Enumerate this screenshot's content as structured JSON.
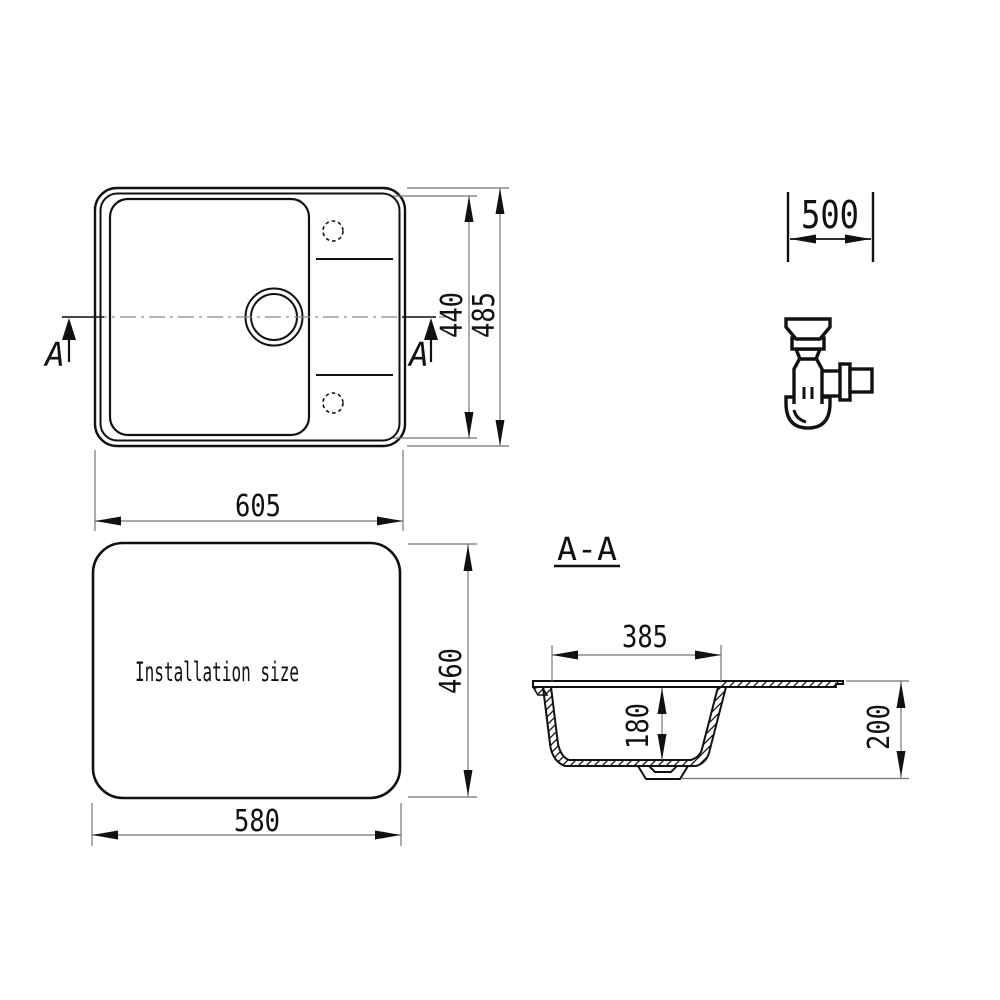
{
  "colors": {
    "background": "#ffffff",
    "object_line": "#111111",
    "dimension_line": "#757575"
  },
  "top_view": {
    "description": "sink plan view",
    "dim_width": "605",
    "dim_depth_inner": "440",
    "dim_depth_outer": "485",
    "section_marker_left": "A",
    "section_marker_right": "A"
  },
  "install_view": {
    "label": "Installation size",
    "dim_width": "580",
    "dim_depth": "460"
  },
  "section_view": {
    "title": "A-A",
    "dim_bowl_width": "385",
    "dim_bowl_depth": "180",
    "dim_overall_depth": "200"
  },
  "cabinet": {
    "dim_min_cabinet_width": "500"
  }
}
